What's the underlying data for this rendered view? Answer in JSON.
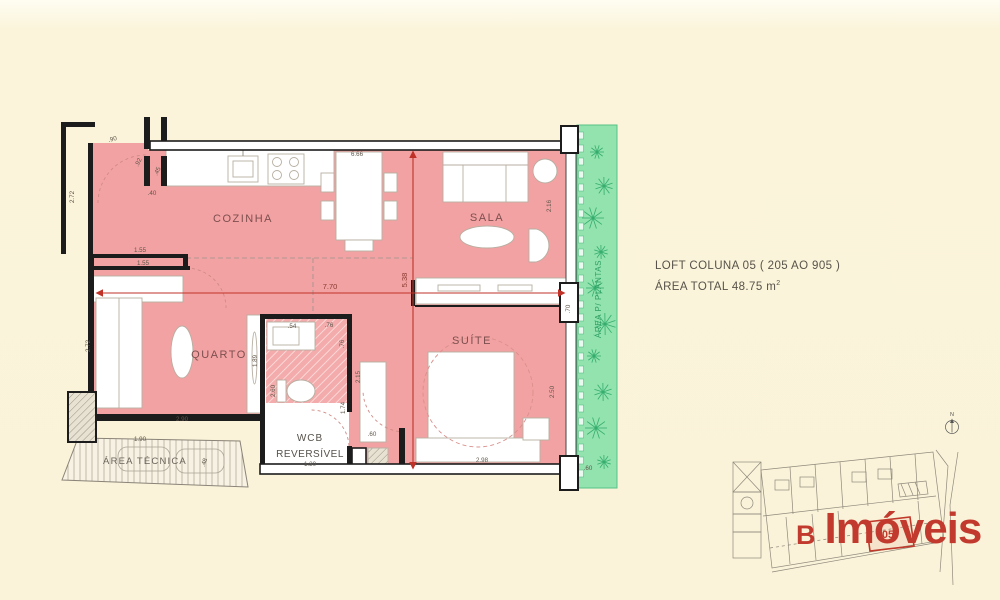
{
  "header": {
    "title": "LOFT COLUNA 05 ( 205 AO 905 )",
    "area_prefix": "ÁREA TOTAL  48.75 m",
    "area_sup": "2"
  },
  "plan": {
    "colors": {
      "floor_pink": "#f2a2a2",
      "garden_green": "#92e3ae",
      "wall_black": "#1c1c1c",
      "dim_red": "#c03228",
      "dim_text": "#5f564b",
      "room_label": "#7d4f4f",
      "garden_label": "#2f9e63"
    },
    "rooms": [
      {
        "id": "cozinha",
        "label": "COZINHA",
        "x": 243,
        "y": 222,
        "size": 11,
        "ls": 1.5,
        "color": "#7d4f4f",
        "r": 0
      },
      {
        "id": "sala",
        "label": "SALA",
        "x": 487,
        "y": 221,
        "size": 11,
        "ls": 1.5,
        "color": "#7d4f4f",
        "r": 0
      },
      {
        "id": "quarto",
        "label": "QUARTO",
        "x": 219,
        "y": 358,
        "size": 11,
        "ls": 1.5,
        "color": "#7d4f4f",
        "r": 0
      },
      {
        "id": "suite",
        "label": "SUÍTE",
        "x": 472,
        "y": 344,
        "size": 11,
        "ls": 1.5,
        "color": "#7d4f4f",
        "r": 0
      },
      {
        "id": "wcb-line1",
        "label": "WCB",
        "x": 310,
        "y": 441,
        "size": 10,
        "ls": 1,
        "color": "#55504a",
        "r": 0
      },
      {
        "id": "wcb-line2",
        "label": "REVERSÍVEL",
        "x": 310,
        "y": 457,
        "size": 10,
        "ls": 0.5,
        "color": "#55504a",
        "r": 0
      },
      {
        "id": "area-tecnica",
        "label": "ÁREA TÉCNICA",
        "x": 145,
        "y": 464,
        "size": 9.5,
        "ls": 1.2,
        "color": "#6b635a",
        "r": 0
      },
      {
        "id": "area-plantas",
        "label": "ÁREA P/ PLANTAS",
        "x": 601,
        "y": 299,
        "size": 8,
        "ls": 0.6,
        "color": "#2f9e63",
        "r": -90
      }
    ],
    "dimensions": [
      {
        "t": ".90",
        "x": 113,
        "y": 141,
        "r": -15
      },
      {
        "t": ".92",
        "x": 140,
        "y": 163,
        "r": -65
      },
      {
        "t": ".45",
        "x": 159,
        "y": 172,
        "r": -65
      },
      {
        "t": ".40",
        "x": 152,
        "y": 195,
        "r": 0
      },
      {
        "t": "2.72",
        "x": 74,
        "y": 197,
        "r": -90
      },
      {
        "t": "1.55",
        "x": 140,
        "y": 252,
        "r": 0
      },
      {
        "t": "1.55",
        "x": 143,
        "y": 265,
        "r": 0
      },
      {
        "t": "6.66",
        "x": 357,
        "y": 156,
        "r": 0
      },
      {
        "t": "2.16",
        "x": 551,
        "y": 206,
        "r": -90
      },
      {
        "t": ".70",
        "x": 570,
        "y": 309,
        "r": -90
      },
      {
        "t": "2.72",
        "x": 90,
        "y": 346,
        "r": -90
      },
      {
        "t": "1.89",
        "x": 257,
        "y": 361,
        "r": -90
      },
      {
        "t": "2.90",
        "x": 182,
        "y": 421,
        "r": 0
      },
      {
        "t": "1.90",
        "x": 140,
        "y": 441,
        "r": 0
      },
      {
        "t": ".48",
        "x": 206,
        "y": 463,
        "r": -70
      },
      {
        "t": "2.60",
        "x": 275,
        "y": 391,
        "r": -90
      },
      {
        "t": ".54",
        "x": 292,
        "y": 328,
        "r": 0
      },
      {
        "t": ".76",
        "x": 329,
        "y": 327,
        "r": 0
      },
      {
        "t": ".76",
        "x": 344,
        "y": 344,
        "r": -90
      },
      {
        "t": "2.15",
        "x": 360,
        "y": 377,
        "r": -90
      },
      {
        "t": "1.74",
        "x": 345,
        "y": 408,
        "r": -90
      },
      {
        "t": "1.30",
        "x": 310,
        "y": 466,
        "r": 0
      },
      {
        "t": ".60",
        "x": 372,
        "y": 436,
        "r": 0
      },
      {
        "t": "2.50",
        "x": 554,
        "y": 392,
        "r": -90
      },
      {
        "t": "2.98",
        "x": 482,
        "y": 462,
        "r": 0
      },
      {
        "t": ".60",
        "x": 588,
        "y": 470,
        "r": 0
      }
    ],
    "red_dims": {
      "h": "7.70",
      "v": "5.38"
    }
  },
  "key_plan": {
    "unit_label": "05",
    "compass_label": "N"
  },
  "logo": {
    "prefix": "B",
    "name": "Imóveis"
  }
}
